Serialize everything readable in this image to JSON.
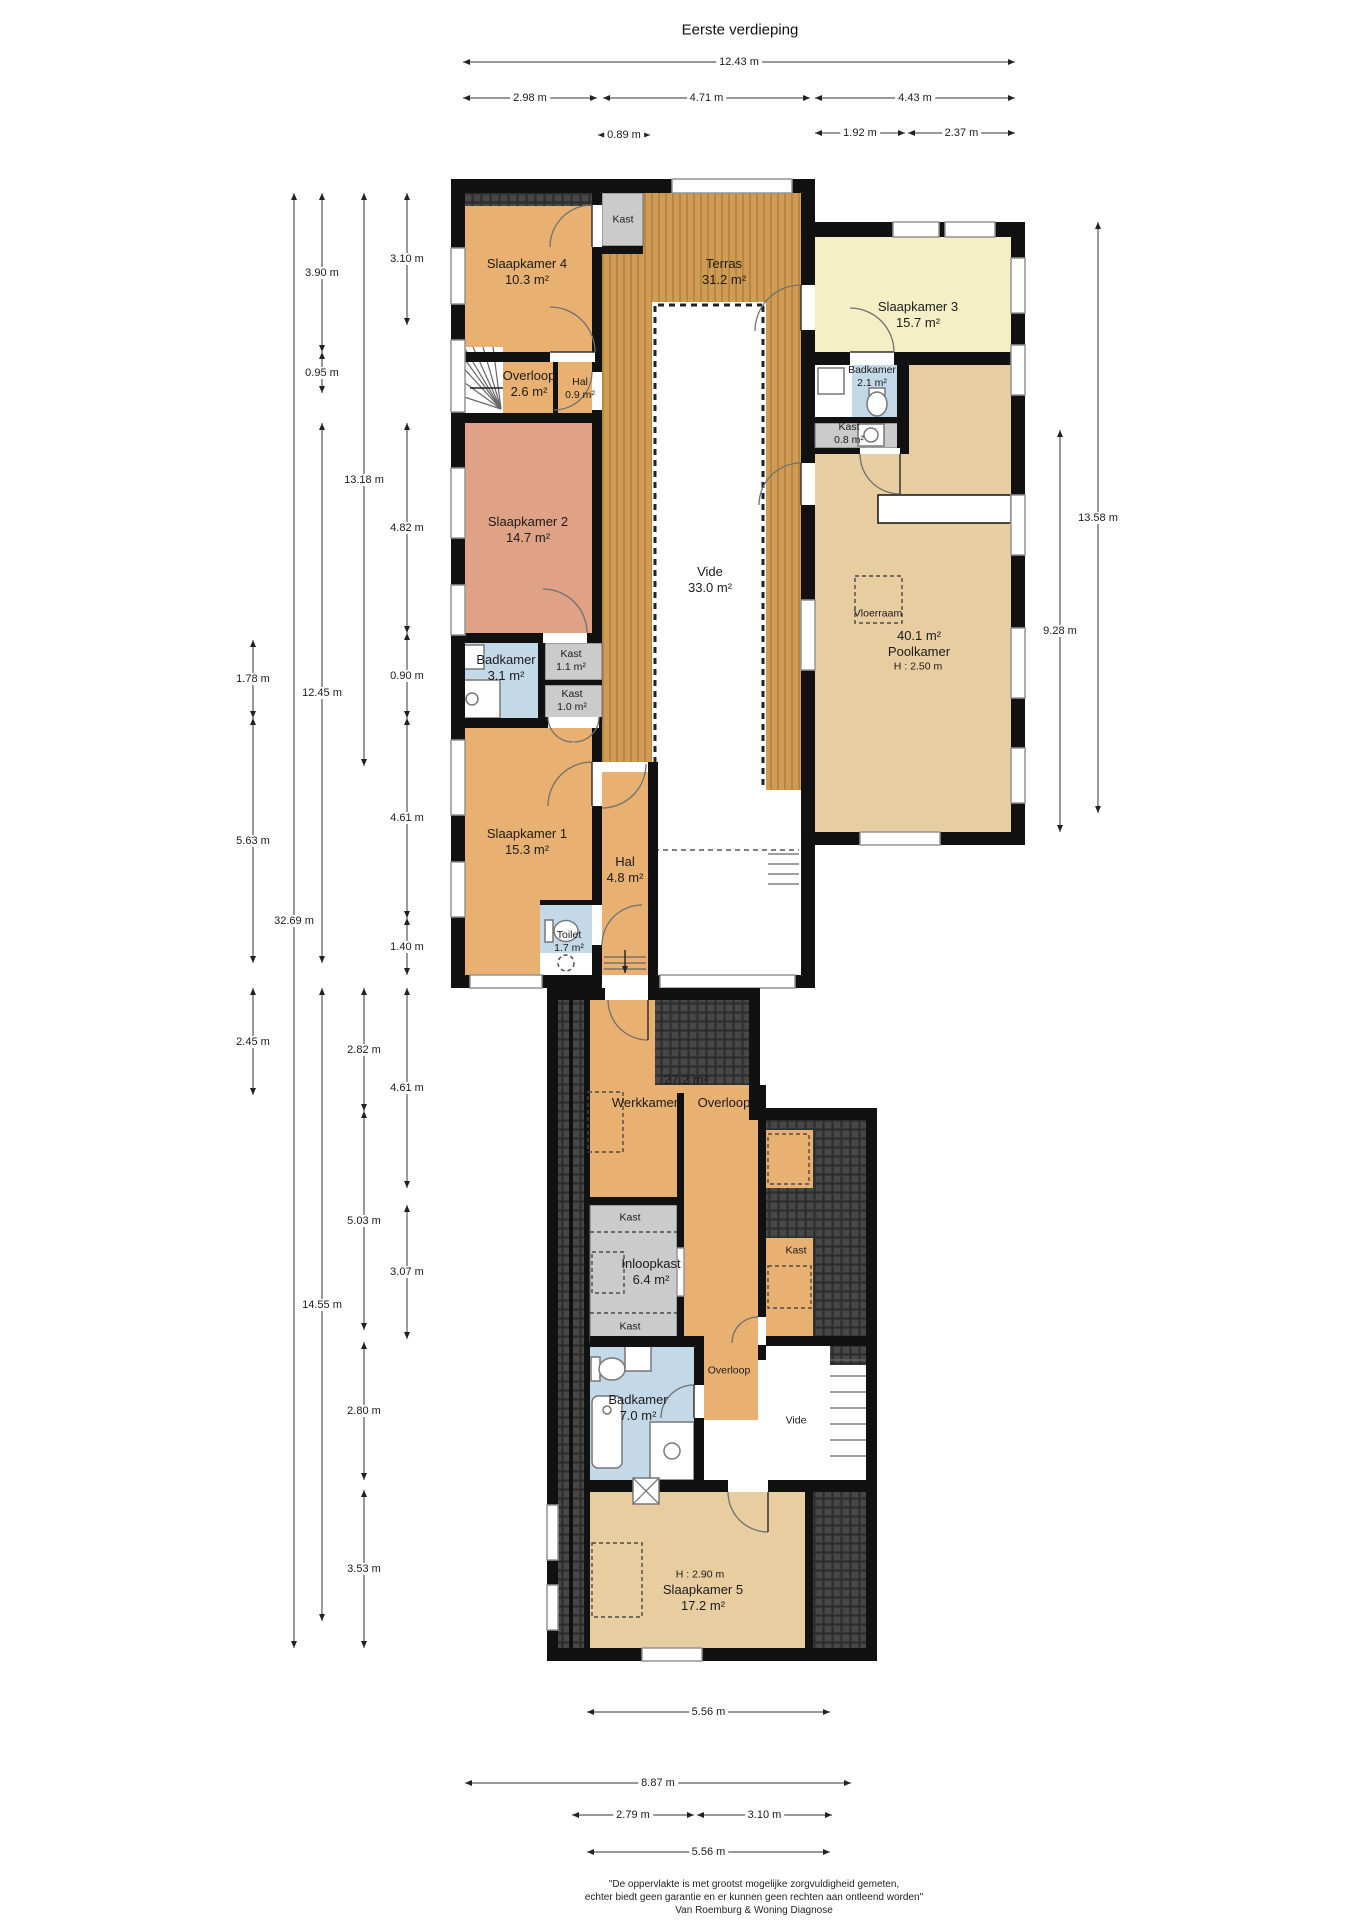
{
  "title": "Eerste verdieping",
  "footer": {
    "line1": "\"De oppervlakte is met grootst mogelijke zorgvuldigheid gemeten,",
    "line2": "echter biedt geen garantie en er kunnen geen rechten aan ontleend worden\"",
    "line3": "Van Roemburg & Woning Diagnose"
  },
  "colors": {
    "wall": "#111111",
    "orange": "#e8b172",
    "salmon": "#dfa285",
    "yellow": "#f4efc5",
    "tan": "#e8cda1",
    "blue": "#c3d9e8",
    "gray": "#cbcbcb",
    "wood": "#cf9c55",
    "woodline": "#b5813e",
    "hatch": "#474747",
    "hatchline": "#2d2d2d"
  },
  "rooms": [
    {
      "lines": [
        "Slaapkamer 4",
        "10.3 m²"
      ],
      "x": 527,
      "y": 272
    },
    {
      "lines": [
        "Kast"
      ],
      "x": 623,
      "y": 220,
      "small": true
    },
    {
      "lines": [
        "Terras",
        "31.2 m²"
      ],
      "x": 724,
      "y": 272
    },
    {
      "lines": [
        "Slaapkamer 3",
        "15.7 m²"
      ],
      "x": 918,
      "y": 315
    },
    {
      "lines": [
        "Badkamer",
        "2.1 m²"
      ],
      "x": 872,
      "y": 377,
      "small": true
    },
    {
      "lines": [
        "Kast",
        "0.8 m²"
      ],
      "x": 849,
      "y": 434,
      "small": true
    },
    {
      "lines": [
        "Overloop",
        "2.6 m²"
      ],
      "x": 529,
      "y": 384
    },
    {
      "lines": [
        "Hal",
        "0.9 m²"
      ],
      "x": 580,
      "y": 389,
      "small": true
    },
    {
      "lines": [
        "Slaapkamer 2",
        "14.7 m²"
      ],
      "x": 528,
      "y": 530
    },
    {
      "lines": [
        "Vide",
        "33.0 m²"
      ],
      "x": 710,
      "y": 580
    },
    {
      "lines": [
        "Badkamer",
        "3.1 m²"
      ],
      "x": 506,
      "y": 668
    },
    {
      "lines": [
        "Kast",
        "1.1 m²"
      ],
      "x": 571,
      "y": 661,
      "small": true
    },
    {
      "lines": [
        "Kast",
        "1.0 m²"
      ],
      "x": 572,
      "y": 701,
      "small": true
    },
    {
      "lines": [
        "Vloerraam"
      ],
      "x": 878,
      "y": 614,
      "small": true
    },
    {
      "lines": [
        "40.1 m²",
        "Poolkamer"
      ],
      "x": 919,
      "y": 644
    },
    {
      "lines": [
        "H : 2.50 m"
      ],
      "x": 918,
      "y": 667,
      "small": true
    },
    {
      "lines": [
        "Slaapkamer 1",
        "15.3 m²"
      ],
      "x": 527,
      "y": 842
    },
    {
      "lines": [
        "Hal",
        "4.8 m²"
      ],
      "x": 625,
      "y": 870
    },
    {
      "lines": [
        "Toilet",
        "1.7 m²"
      ],
      "x": 569,
      "y": 942,
      "small": true
    },
    {
      "lines": [
        "27.2 m²"
      ],
      "x": 686,
      "y": 1080
    },
    {
      "lines": [
        "Werkkamer"
      ],
      "x": 645,
      "y": 1103
    },
    {
      "lines": [
        "Overloop"
      ],
      "x": 724,
      "y": 1103
    },
    {
      "lines": [
        "Kast"
      ],
      "x": 630,
      "y": 1218,
      "small": true
    },
    {
      "lines": [
        "Inloopkast",
        "6.4 m²"
      ],
      "x": 651,
      "y": 1272
    },
    {
      "lines": [
        "Kast"
      ],
      "x": 630,
      "y": 1327,
      "small": true
    },
    {
      "lines": [
        "Kast"
      ],
      "x": 796,
      "y": 1251,
      "small": true
    },
    {
      "lines": [
        "Overloop"
      ],
      "x": 729,
      "y": 1371,
      "small": true
    },
    {
      "lines": [
        "Badkamer",
        "7.0 m²"
      ],
      "x": 638,
      "y": 1408
    },
    {
      "lines": [
        "Vide"
      ],
      "x": 796,
      "y": 1421,
      "small": true
    },
    {
      "lines": [
        "H : 2.90 m"
      ],
      "x": 700,
      "y": 1575,
      "small": true
    },
    {
      "lines": [
        "Slaapkamer 5",
        "17.2 m²"
      ],
      "x": 703,
      "y": 1598
    }
  ],
  "dimensions": [
    {
      "o": "h",
      "label": "12.43 m",
      "a": 463,
      "b": 1015,
      "p": 62
    },
    {
      "o": "h",
      "label": "2.98 m",
      "a": 463,
      "b": 597,
      "p": 98
    },
    {
      "o": "h",
      "label": "4.71 m",
      "a": 603,
      "b": 810,
      "p": 98
    },
    {
      "o": "h",
      "label": "4.43 m",
      "a": 815,
      "b": 1015,
      "p": 98
    },
    {
      "o": "h",
      "label": "0.89 m",
      "a": 598,
      "b": 650,
      "p": 135
    },
    {
      "o": "h",
      "label": "1.92 m",
      "a": 815,
      "b": 905,
      "p": 133
    },
    {
      "o": "h",
      "label": "2.37 m",
      "a": 908,
      "b": 1015,
      "p": 133
    },
    {
      "o": "h",
      "label": "5.56 m",
      "a": 587,
      "b": 830,
      "p": 1712
    },
    {
      "o": "h",
      "label": "8.87 m",
      "a": 465,
      "b": 851,
      "p": 1783
    },
    {
      "o": "h",
      "label": "2.79 m",
      "a": 572,
      "b": 694,
      "p": 1815
    },
    {
      "o": "h",
      "label": "3.10 m",
      "a": 697,
      "b": 832,
      "p": 1815
    },
    {
      "o": "h",
      "label": "5.56 m",
      "a": 587,
      "b": 830,
      "p": 1852
    },
    {
      "o": "v",
      "label": "1.78 m",
      "a": 640,
      "b": 718,
      "p": 253
    },
    {
      "o": "v",
      "label": "5.63 m",
      "a": 718,
      "b": 963,
      "p": 253
    },
    {
      "o": "v",
      "label": "2.45 m",
      "a": 988,
      "b": 1095,
      "p": 253
    },
    {
      "o": "v",
      "label": "32.69 m",
      "a": 193,
      "b": 1648,
      "p": 294
    },
    {
      "o": "v",
      "label": "3.90 m",
      "a": 193,
      "b": 352,
      "p": 322
    },
    {
      "o": "v",
      "label": "0.95 m",
      "a": 352,
      "b": 393,
      "p": 322
    },
    {
      "o": "v",
      "label": "12.45 m",
      "a": 423,
      "b": 963,
      "p": 322
    },
    {
      "o": "v",
      "label": "14.55 m",
      "a": 988,
      "b": 1621,
      "p": 322
    },
    {
      "o": "v",
      "label": "13.18 m",
      "a": 193,
      "b": 766,
      "p": 364
    },
    {
      "o": "v",
      "label": "2.82 m",
      "a": 988,
      "b": 1111,
      "p": 364
    },
    {
      "o": "v",
      "label": "5.03 m",
      "a": 1111,
      "b": 1330,
      "p": 364
    },
    {
      "o": "v",
      "label": "2.80 m",
      "a": 1342,
      "b": 1480,
      "p": 364
    },
    {
      "o": "v",
      "label": "3.53 m",
      "a": 1490,
      "b": 1648,
      "p": 364
    },
    {
      "o": "v",
      "label": "3.10 m",
      "a": 193,
      "b": 325,
      "p": 407
    },
    {
      "o": "v",
      "label": "4.82 m",
      "a": 423,
      "b": 633,
      "p": 407
    },
    {
      "o": "v",
      "label": "0.90 m",
      "a": 633,
      "b": 718,
      "p": 407
    },
    {
      "o": "v",
      "label": "4.61 m",
      "a": 718,
      "b": 918,
      "p": 407
    },
    {
      "o": "v",
      "label": "1.40 m",
      "a": 918,
      "b": 975,
      "p": 407
    },
    {
      "o": "v",
      "label": "4.61 m",
      "a": 988,
      "b": 1188,
      "p": 407
    },
    {
      "o": "v",
      "label": "3.07 m",
      "a": 1205,
      "b": 1339,
      "p": 407
    },
    {
      "o": "v",
      "label": "9.28 m",
      "a": 430,
      "b": 832,
      "p": 1060
    },
    {
      "o": "v",
      "label": "13.58 m",
      "a": 222,
      "b": 813,
      "p": 1098
    }
  ]
}
